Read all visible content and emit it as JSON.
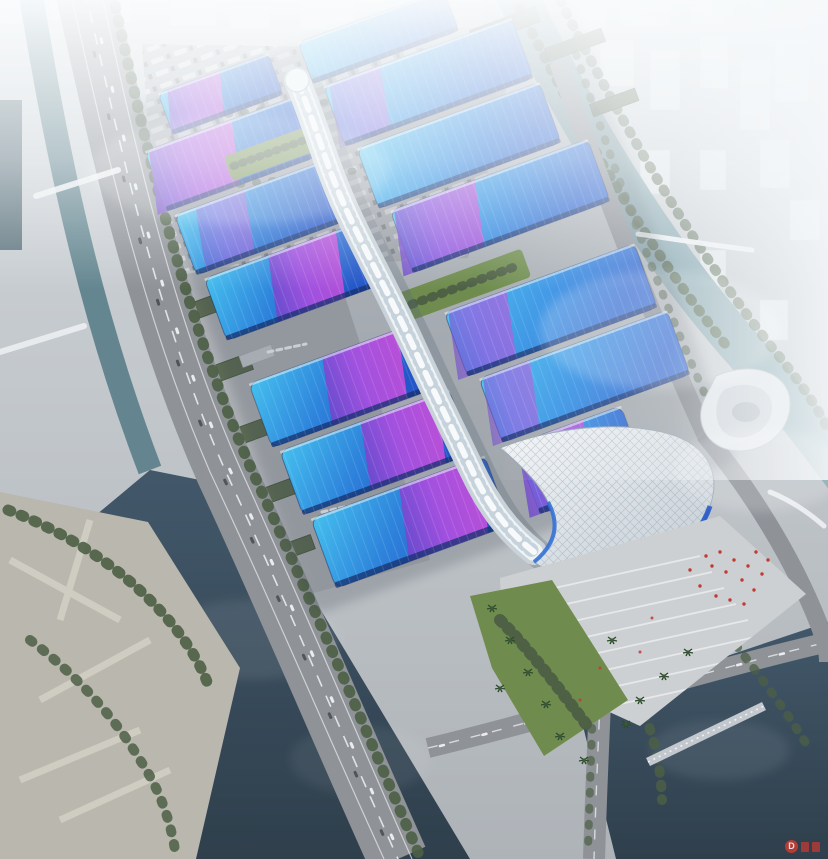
{
  "meta": {
    "title": "Aerial rendering of a riverside exhibition and convention center",
    "width_px": 828,
    "height_px": 859
  },
  "scene": {
    "regions": [
      {
        "name": "foggy-city-skyline",
        "position": "top"
      },
      {
        "name": "river-east",
        "position": "upper-right"
      },
      {
        "name": "canal-west",
        "position": "upper-left"
      },
      {
        "name": "highway-west",
        "position": "left"
      },
      {
        "name": "truck-parking",
        "position": "upper-left"
      },
      {
        "name": "service-yards",
        "position": "west-of-halls"
      },
      {
        "name": "exhibition-halls",
        "position": "center"
      },
      {
        "name": "serpentine-skywalk",
        "position": "central-spine"
      },
      {
        "name": "south-entrance-canopy",
        "position": "bottom-center"
      },
      {
        "name": "arrival-plaza",
        "position": "bottom-center"
      },
      {
        "name": "swirl-landmark-building",
        "position": "east-of-entrance"
      },
      {
        "name": "waterfront-park",
        "position": "bottom-left"
      },
      {
        "name": "river-southwest",
        "position": "bottom-left"
      },
      {
        "name": "pond-southeast",
        "position": "bottom-right"
      }
    ],
    "exhibition_halls": {
      "rows": 7,
      "layout": "paired halls split by central serpentine skywalk",
      "roof_finish": "blue gradient roofs with diagonal purple-magenta ribbon stripes",
      "green_courtyards": 2
    },
    "crowd": {
      "description": "visitors rendered as red specks on entrance plaza"
    }
  },
  "colors": {
    "ground": "#b7bbc0",
    "fog": "#f4f7f9",
    "waterDark": "#3e5362",
    "waterTeal": "#7fa3ab",
    "canal": "#5f828c",
    "road": "#8f9398",
    "roadLight": "#9a9ea3",
    "laneWhite": "#e9ecee",
    "treeDark": "#4c5f45",
    "lawn": "#6f8c4e",
    "lawnDark": "#55713c",
    "roofCyan": "#45c0ee",
    "roofBlue": "#2e84dc",
    "roofDeep": "#2356c8",
    "roofEdge": "#16306e",
    "purple": "#6a48cc",
    "magenta": "#c44fd8",
    "spine": "#eef3f6",
    "canopy": "#e8edf0",
    "plaza": "#cdd0d3",
    "parkBase": "#b9b7ae",
    "parkPath": "#cfccc2",
    "cityBlock": "#e3e8eb",
    "crowdRed": "#c23b33",
    "watermark": "#cf3a31"
  },
  "watermark": {
    "symbol": "D",
    "glyph_blocks": 2
  }
}
